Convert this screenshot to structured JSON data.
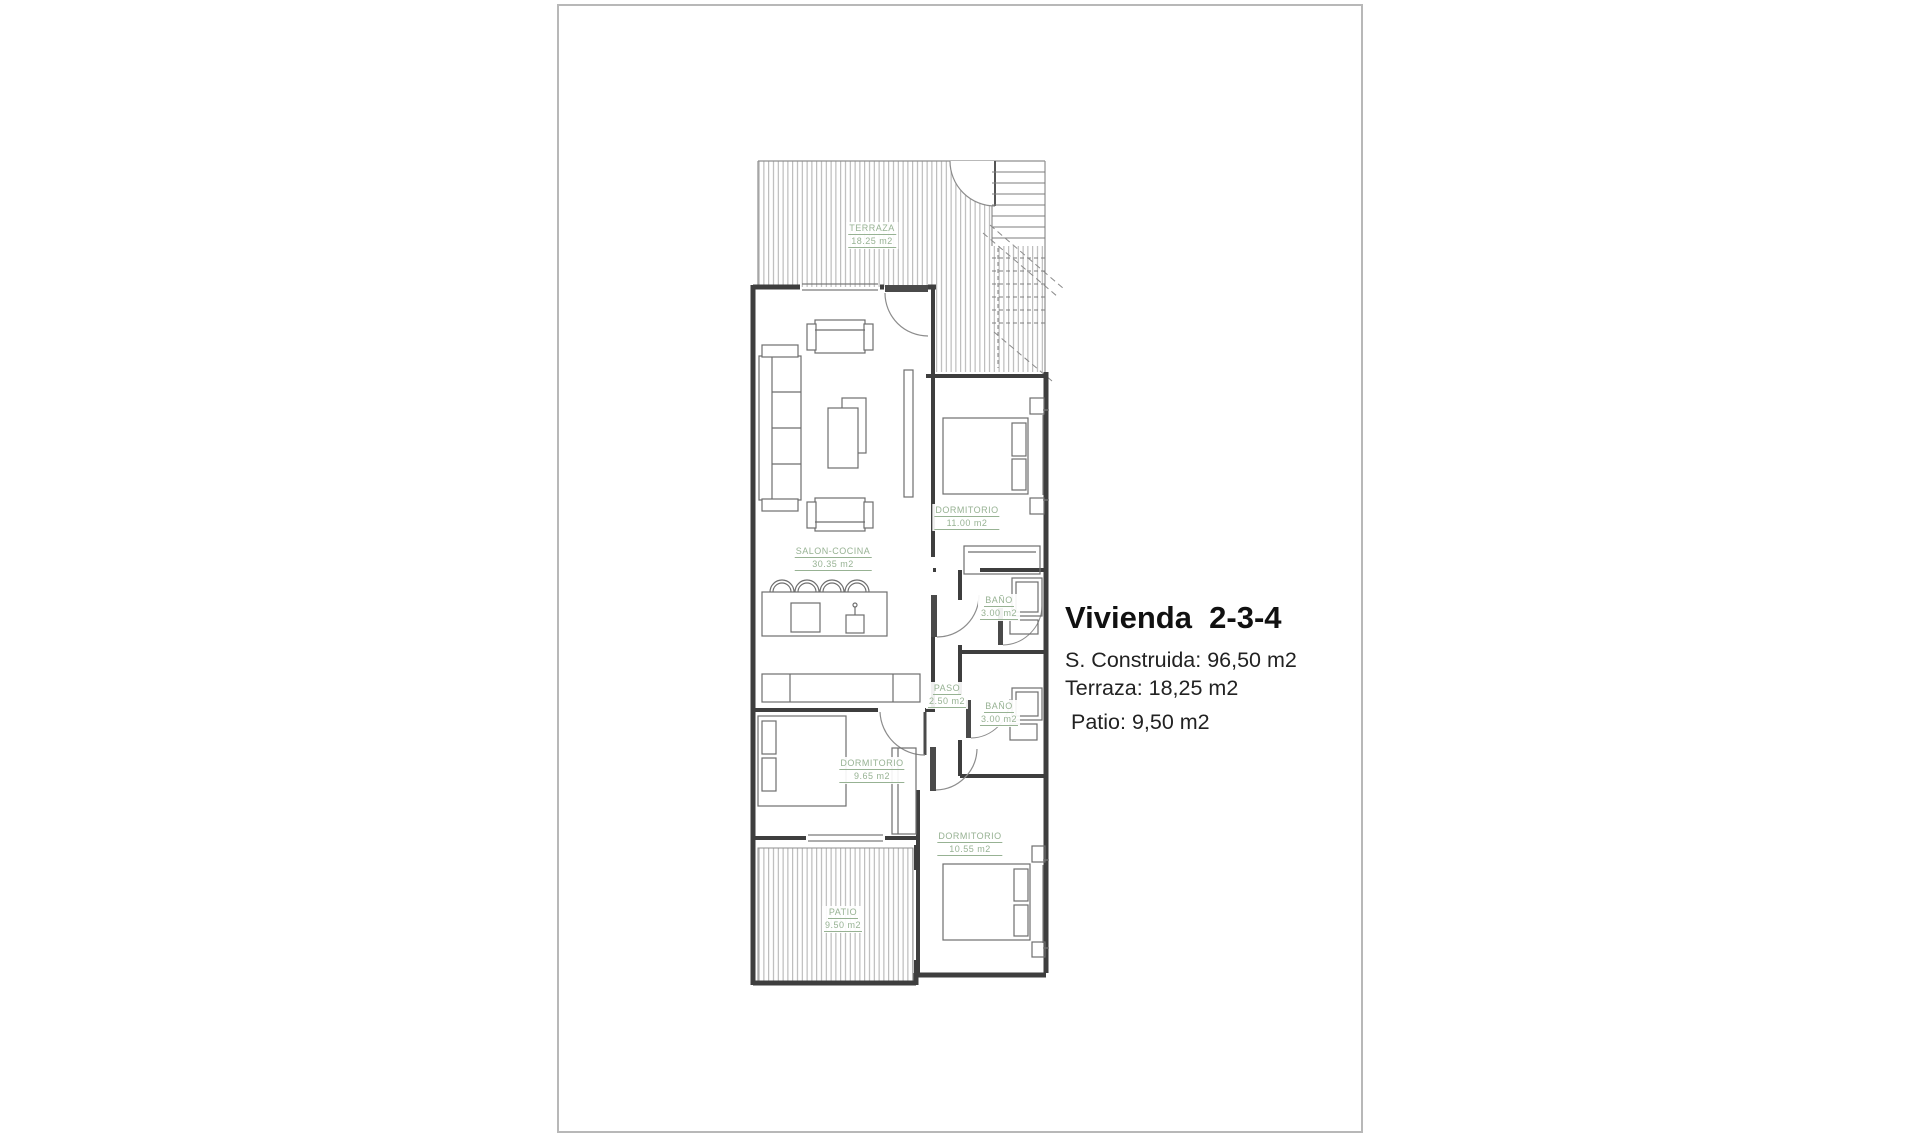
{
  "document": {
    "type": "floor-plan-sheet"
  },
  "info": {
    "title": "Vivienda  2-3-4",
    "construida": "S. Construida: 96,50 m2",
    "terraza": "Terraza: 18,25 m2",
    "patio": "Patio: 9,50 m2"
  },
  "rooms": [
    {
      "name": "TERRAZA",
      "area": "18.25 m2"
    },
    {
      "name": "DORMITORIO",
      "area": "11.00 m2"
    },
    {
      "name": "SALON-COCINA",
      "area": "30.35 m2"
    },
    {
      "name": "BAÑO",
      "area": "3.00 m2"
    },
    {
      "name": "PASO",
      "area": "2.50 m2"
    },
    {
      "name": "BAÑO",
      "area": "3.00 m2"
    },
    {
      "name": "DORMITORIO",
      "area": "9.65 m2"
    },
    {
      "name": "DORMITORIO",
      "area": "10.55 m2"
    },
    {
      "name": "PATIO",
      "area": "9.50 m2"
    }
  ],
  "colors": {
    "label_green": "#97b293",
    "wall": "#3e3e3e",
    "furniture": "#6e6e6e",
    "hatch": "#a6a6a6",
    "page_border": "#b8b8b8",
    "text_dark": "#212121"
  }
}
